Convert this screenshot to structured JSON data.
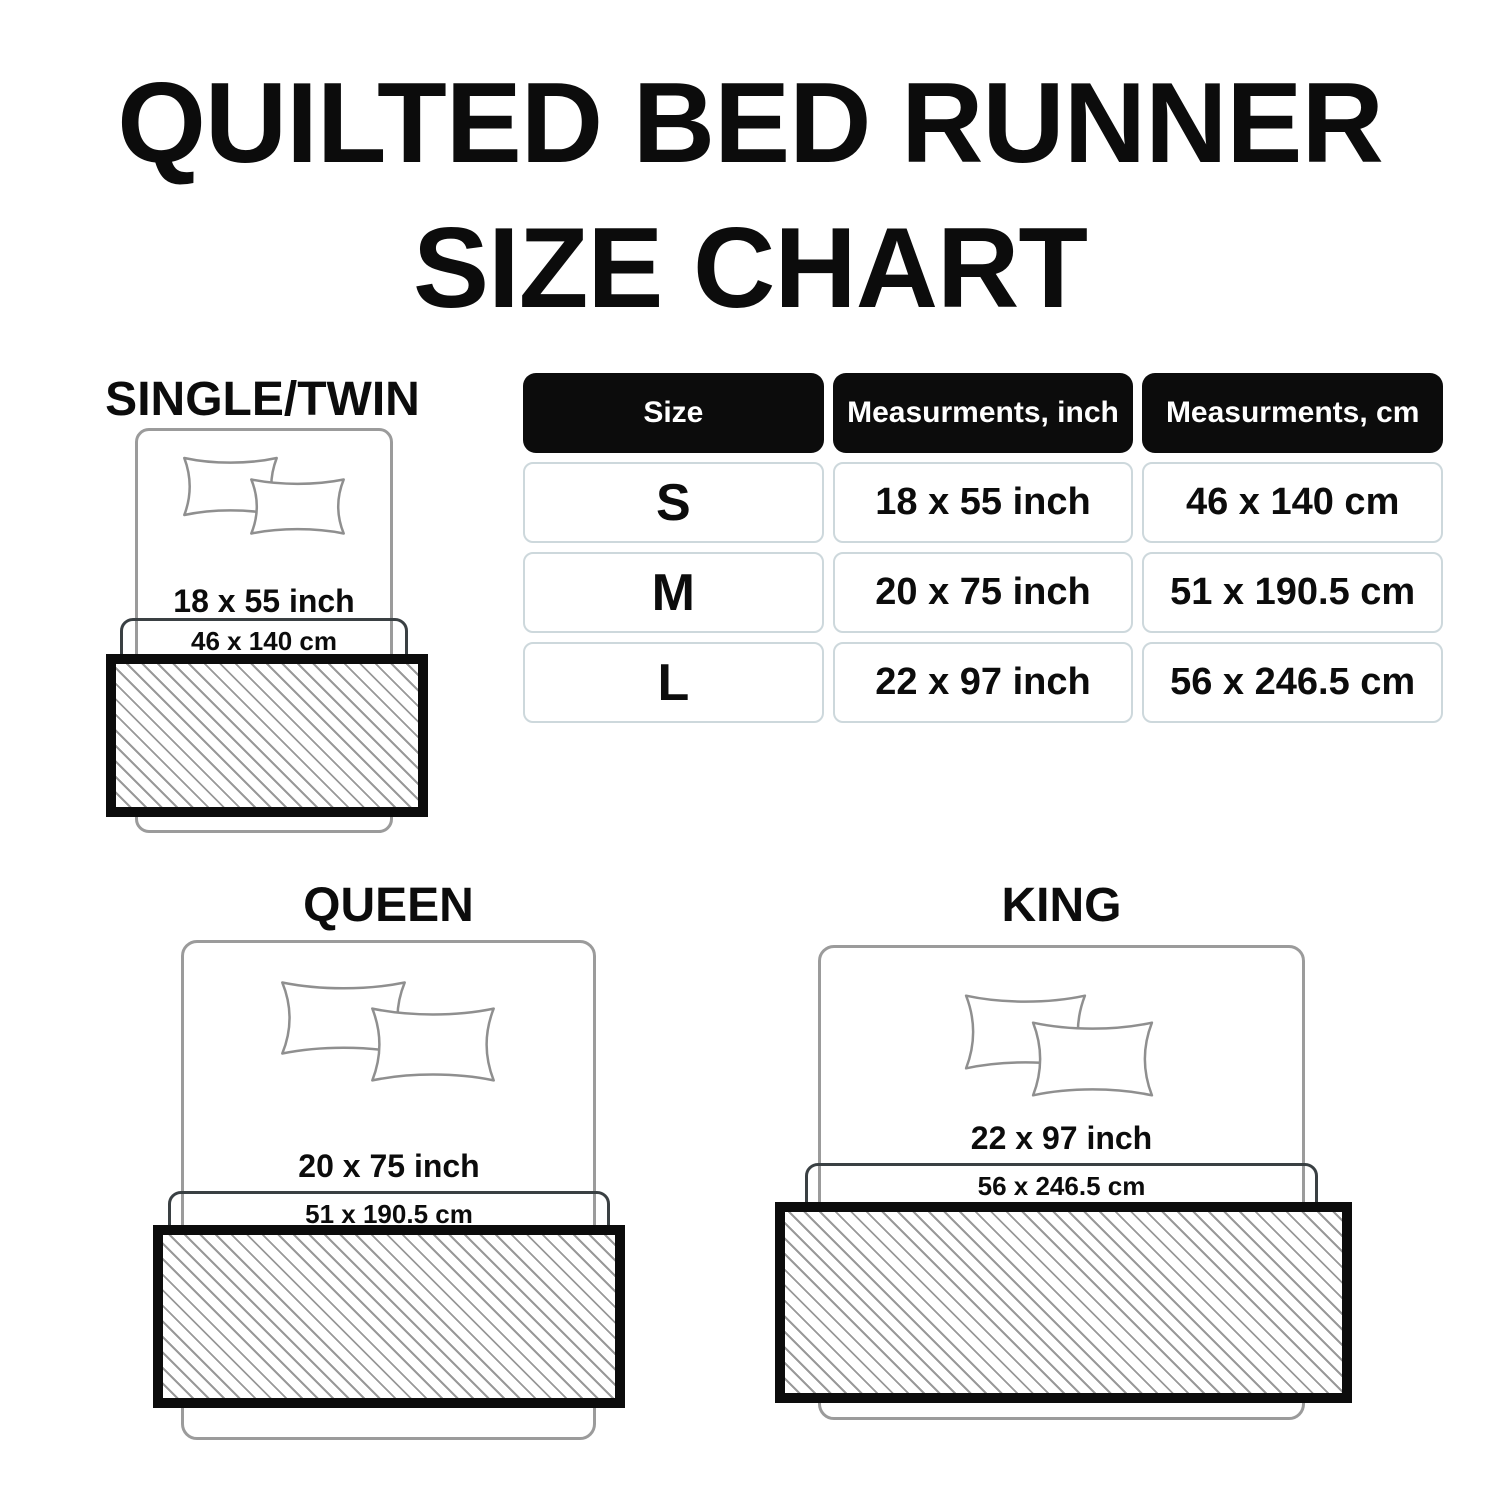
{
  "title": {
    "line1": "QUILTED BED RUNNER",
    "line2": "SIZE CHART"
  },
  "table": {
    "headers": [
      "Size",
      "Measurments, inch",
      "Measurments, cm"
    ],
    "rows": [
      {
        "size": "S",
        "inch": "18 x 55 inch",
        "cm": "46 x 140 cm"
      },
      {
        "size": "M",
        "inch": "20 x 75 inch",
        "cm": "51 x 190.5 cm"
      },
      {
        "size": "L",
        "inch": "22 x 97 inch",
        "cm": "56 x 246.5 cm"
      }
    ]
  },
  "diagrams": {
    "twin": {
      "label": "SINGLE/TWIN",
      "inch": "18 x 55 inch",
      "cm": "46 x 140 cm"
    },
    "queen": {
      "label": "QUEEN",
      "inch": "20 x 75 inch",
      "cm": "51 x 190.5 cm"
    },
    "king": {
      "label": "KING",
      "inch": "22 x 97 inch",
      "cm": "56 x 246.5 cm"
    }
  },
  "colors": {
    "ink": "#0c0c0c",
    "header_bg": "#0c0c0c",
    "header_text": "#ffffff",
    "cell_border": "#cdd8dc",
    "bed_outline": "#9b9b9b",
    "pillow_outline": "#8f8f8f",
    "cm_rect_border": "#3a4043",
    "hatch_line": "#999999",
    "runner_border": "#0c0c0c"
  }
}
